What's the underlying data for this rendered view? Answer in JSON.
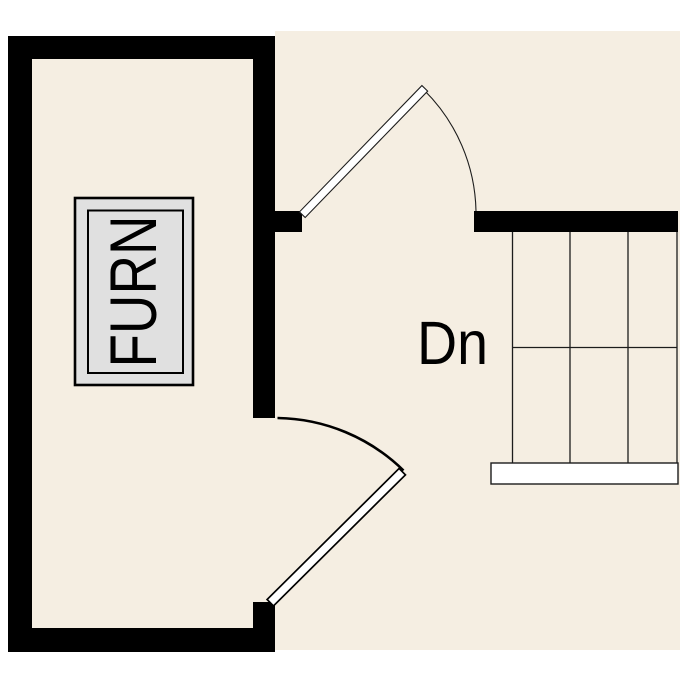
{
  "labels": {
    "furnace": "FURN",
    "stairs_down": "Dn"
  },
  "colors": {
    "background": "#ffffff",
    "floor": "#f5eee2",
    "wall": "#000000",
    "line": "#1c1c1c",
    "furnace_fill": "#e0e0e0",
    "door_fill": "#ffffff",
    "landing_fill": "#ffffff"
  },
  "stairs": {
    "tread_columns": 3,
    "tread_rows": 2,
    "direction": "down"
  },
  "doors": {
    "count": 2,
    "state": "open-45-degrees"
  }
}
